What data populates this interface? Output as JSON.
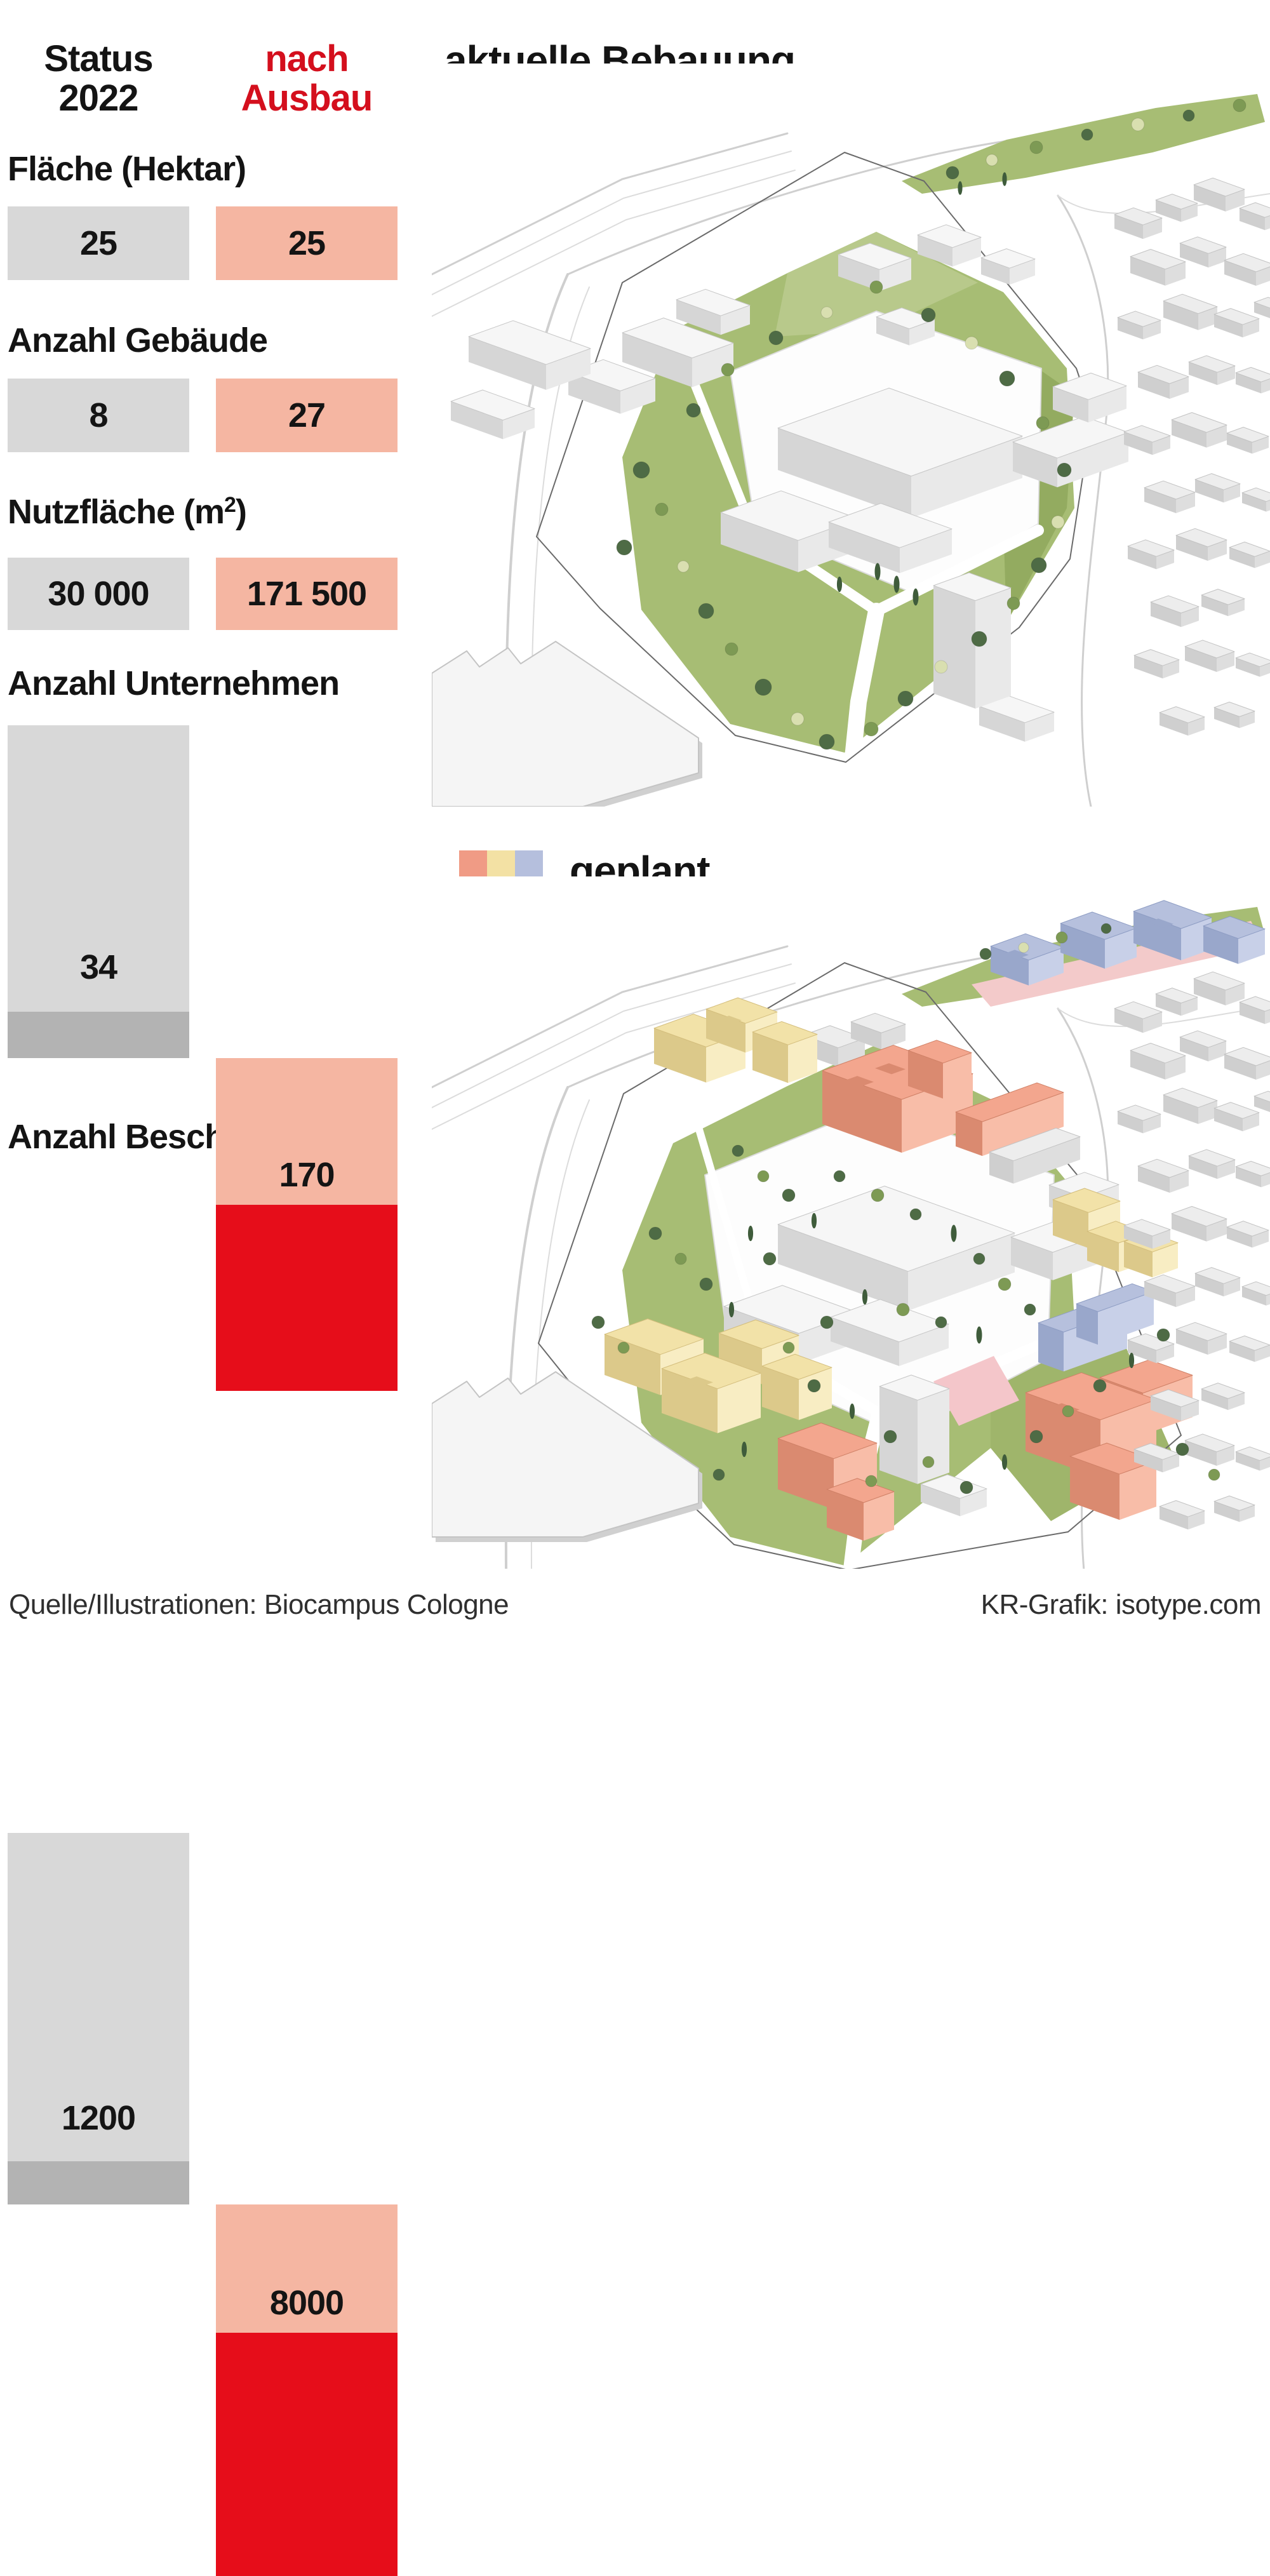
{
  "palette": {
    "ink": "#141414",
    "header_red": "#d40f1d",
    "gray_bar": "#d8d8d8",
    "gray_dark": "#b3b3b3",
    "salmon": "#f5b6a2",
    "red": "#e60d1a",
    "legend_salmon": "#f09b85",
    "legend_yellow": "#f3e1a4",
    "legend_blue": "#b5bfdd",
    "footer_ink": "#2f2f2f",
    "lawn_green": "#a7bd74",
    "tree_dark": "#4e6b45",
    "tree_light": "#d9dfb0"
  },
  "header": {
    "status": {
      "line1": "Status",
      "line2": "2022"
    },
    "ausbau": {
      "line1": "nach",
      "line2": "Ausbau"
    }
  },
  "rows": [
    {
      "label_pre": "Fläche (Hektar)",
      "label_sup": "",
      "label_post": "",
      "status_label": "25",
      "ausbau_label": "25"
    },
    {
      "label_pre": "Anzahl Gebäude",
      "label_sup": "",
      "label_post": "",
      "status_label": "8",
      "ausbau_label": "27"
    },
    {
      "label_pre": "Nutzfläche (m",
      "label_sup": "2",
      "label_post": ")",
      "status_label": "30 000",
      "ausbau_label": "171 500"
    },
    {
      "label_pre": "Anzahl Unternehmen",
      "label_sup": "",
      "label_post": "",
      "status_label": "34",
      "ausbau_label": "170"
    },
    {
      "label_pre": "Anzahl Beschäftigte",
      "label_sup": "",
      "label_post": "",
      "status_label": "1200",
      "ausbau_label": "8000"
    }
  ],
  "maps": {
    "top_title": "aktuelle Bebauung",
    "legend_label": "geplant",
    "legend_colors": [
      "#f09b85",
      "#f3e1a4",
      "#b5bfdd"
    ]
  },
  "footer": {
    "source": "Quelle/Illustrationen: Biocampus Cologne",
    "credit": "KR-Grafik: isotype.com"
  },
  "chart_data": {
    "type": "bar",
    "title": "Biocampus Cologne: Status 2022 vs. nach Ausbau",
    "categories": [
      "Fläche (Hektar)",
      "Anzahl Gebäude",
      "Nutzfläche (m²)",
      "Anzahl Unternehmen",
      "Anzahl Beschäftigte"
    ],
    "series": [
      {
        "name": "Status 2022",
        "values": [
          25,
          8,
          30000,
          34,
          1200
        ],
        "color": "#d8d8d8"
      },
      {
        "name": "nach Ausbau",
        "values": [
          25,
          27,
          171500,
          170,
          8000
        ],
        "color": "#e60d1a"
      }
    ],
    "value_labels": [
      [
        "25",
        "25"
      ],
      [
        "8",
        "27"
      ],
      [
        "30 000",
        "171 500"
      ],
      [
        "34",
        "170"
      ],
      [
        "1200",
        "8000"
      ]
    ],
    "legend_position": "top",
    "grid": false,
    "orientation": "vertical",
    "notes": "Rows 1-3 drawn as equal-height label blocks (gray = Status 2022, salmon = nach Ausbau). Rows 4-5 drawn as tall columns: right column salmon top segment + bright red lower segment, left gray column with darker base strip."
  }
}
